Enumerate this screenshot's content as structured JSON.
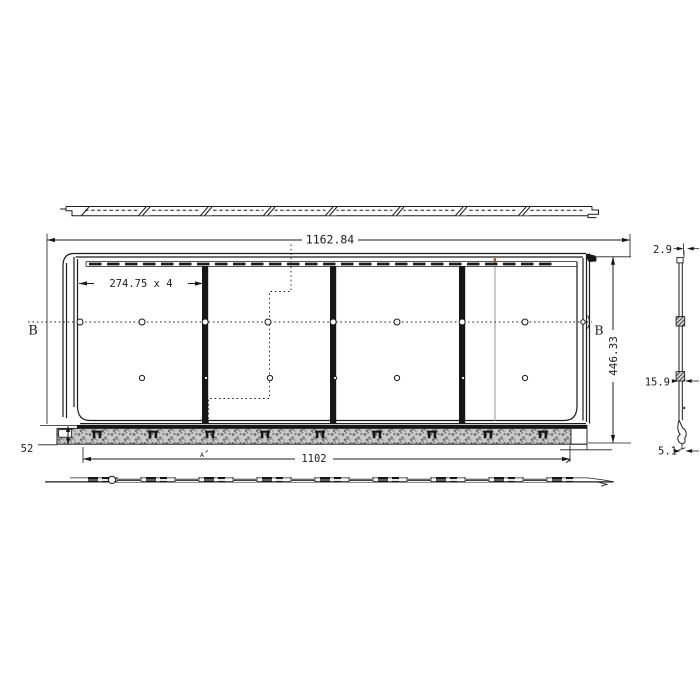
{
  "drawing": {
    "colors": {
      "background": "#ffffff",
      "line": "#1c1c1c",
      "hatch_fill": "#c9c9c9",
      "accent_mark": "#a5503c"
    },
    "dimensions": {
      "top_overall": "1162.84",
      "module_pitch": "274.75 x 4",
      "height_overall": "446.33",
      "bottom_width": "1102",
      "skirt_height": "52",
      "profile_top": "2.9",
      "profile_mid": "15.9",
      "profile_bottom": "5.1"
    },
    "labels": {
      "section_left": "B",
      "section_right": "B",
      "detail": "A"
    }
  }
}
